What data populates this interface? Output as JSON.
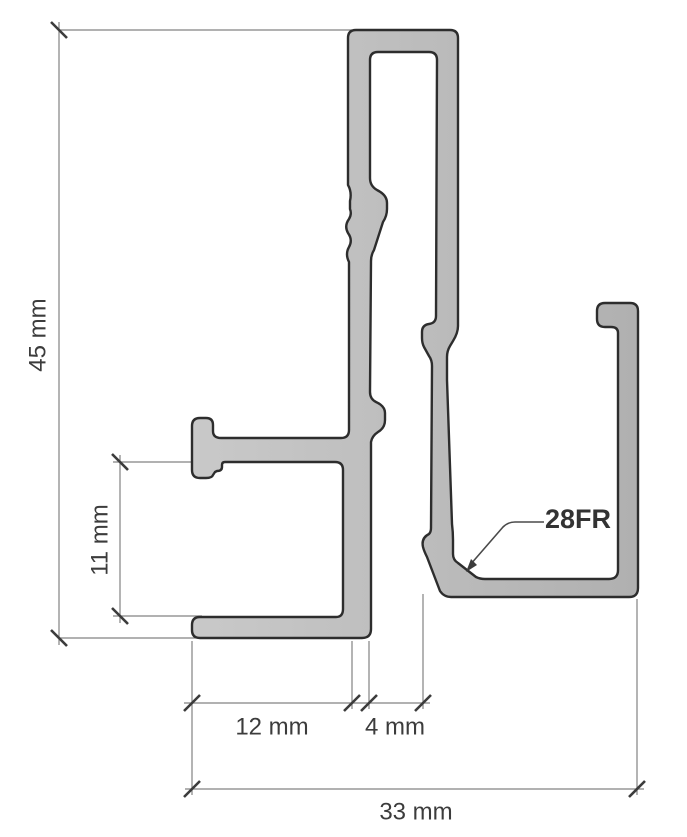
{
  "drawing": {
    "part_label": "28FR",
    "dimensions": {
      "overall_height": "45 mm",
      "hook_opening_height": "11 mm",
      "foot_width": "12 mm",
      "slot_width": "4 mm",
      "overall_width": "33 mm"
    },
    "colors": {
      "background": "#ffffff",
      "profile_fill_light": "#c9c9c9",
      "profile_fill_dark": "#b0b0b0",
      "profile_outline": "#2d2d2d",
      "dimension_line": "#828282",
      "tick": "#3c3c3c",
      "label_text": "#3c3c3c"
    }
  }
}
